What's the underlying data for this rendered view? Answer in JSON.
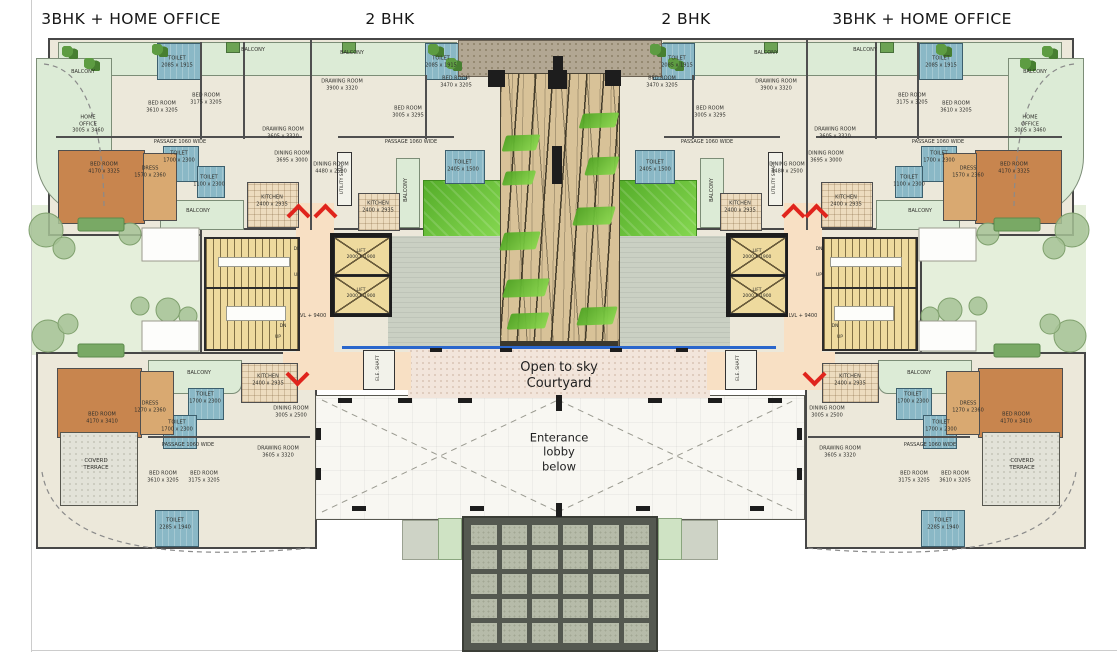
{
  "header": {
    "unit_types": [
      "3BHK + HOME OFFICE",
      "2 BHK",
      "2 BHK",
      "3BHK + HOME OFFICE"
    ]
  },
  "courtyard": {
    "label": "Open to sky\nCourtyard"
  },
  "lobby": {
    "label": "Enterance\nlobby\nbelow"
  },
  "colors": {
    "wall": "#474747",
    "floor": "#ece8da",
    "balcony": "#dcebd6",
    "lawn": "#5cb32e",
    "deck": "#d8c298",
    "toilet": "#8ab8c6",
    "master_bedroom": "#c8854e",
    "corridor": "#f8e0c4",
    "stair": "#eeda9e",
    "courtyard": "#f2e5db",
    "accent_arrow": "#e0241c",
    "water_line": "#2a66cc"
  },
  "chevrons": [
    {
      "x": 290,
      "y": 207,
      "dir": "up"
    },
    {
      "x": 317,
      "y": 207,
      "dir": "up"
    },
    {
      "x": 289,
      "y": 366,
      "dir": "down"
    },
    {
      "x": 785,
      "y": 207,
      "dir": "up"
    },
    {
      "x": 808,
      "y": 207,
      "dir": "up"
    },
    {
      "x": 806,
      "y": 366,
      "dir": "down"
    }
  ],
  "plan_labels": [
    {
      "text": "LVL + 9400",
      "x": 312,
      "y": 316,
      "size": 5
    },
    {
      "text": "LVL + 9400",
      "x": 803,
      "y": 316,
      "size": 5
    },
    {
      "text": "ELE. SHAFT",
      "x": 379,
      "y": 368,
      "size": 4.5,
      "rot": -90
    },
    {
      "text": "ELE. SHAFT",
      "x": 739,
      "y": 368,
      "size": 4.5,
      "rot": -90
    },
    {
      "text": "UTILITY SHAFT",
      "x": 343,
      "y": 178,
      "size": 4.5,
      "rot": -90
    },
    {
      "text": "UTILITY SHAFT",
      "x": 775,
      "y": 178,
      "size": 4.5,
      "rot": -90
    },
    {
      "text": "LIFT\n2000 X 1900",
      "x": 361,
      "y": 255,
      "size": 4.5
    },
    {
      "text": "LIFT\n2000 X 1900",
      "x": 361,
      "y": 294,
      "size": 4.5
    },
    {
      "text": "LIFT\n2000 X 1900",
      "x": 757,
      "y": 255,
      "size": 4.5
    },
    {
      "text": "LIFT\n2000 X 1900",
      "x": 757,
      "y": 294,
      "size": 4.5
    },
    {
      "text": "DN",
      "x": 297,
      "y": 250,
      "size": 4.5
    },
    {
      "text": "UP",
      "x": 297,
      "y": 276,
      "size": 4.5
    },
    {
      "text": "DN",
      "x": 283,
      "y": 327,
      "size": 4.5
    },
    {
      "text": "UP",
      "x": 278,
      "y": 338,
      "size": 4.5
    },
    {
      "text": "DN",
      "x": 819,
      "y": 250,
      "size": 4.5
    },
    {
      "text": "UP",
      "x": 819,
      "y": 276,
      "size": 4.5
    },
    {
      "text": "DN",
      "x": 835,
      "y": 327,
      "size": 4.5
    },
    {
      "text": "UP",
      "x": 840,
      "y": 338,
      "size": 4.5
    },
    {
      "text": "BALCONY",
      "x": 83,
      "y": 72
    },
    {
      "text": "TOILET\n2085 x 1915",
      "x": 177,
      "y": 62
    },
    {
      "text": "BED ROOM\n3610 x 3205",
      "x": 162,
      "y": 107
    },
    {
      "text": "BED ROOM\n3175 x 3205",
      "x": 206,
      "y": 99
    },
    {
      "text": "HOME\nOFFICE\n3005 x 3460",
      "x": 88,
      "y": 124
    },
    {
      "text": "DRAWING ROOM\n3605 x 3320",
      "x": 283,
      "y": 133
    },
    {
      "text": "PASSAGE 1060 WIDE",
      "x": 180,
      "y": 142
    },
    {
      "text": "BED ROOM\n4170 x 3325",
      "x": 104,
      "y": 168
    },
    {
      "text": "DRESS\n1570 x 2360",
      "x": 150,
      "y": 172
    },
    {
      "text": "TOILET\n1700 x 2300",
      "x": 179,
      "y": 157
    },
    {
      "text": "TOILET\n1100 x 2300",
      "x": 209,
      "y": 181
    },
    {
      "text": "DINING ROOM\n3695 x 3000",
      "x": 292,
      "y": 157
    },
    {
      "text": "BALCONY",
      "x": 198,
      "y": 211
    },
    {
      "text": "KITCHEN\n2400 x 2935",
      "x": 272,
      "y": 201
    },
    {
      "text": "BALCONY",
      "x": 253,
      "y": 50
    },
    {
      "text": "BALCONY",
      "x": 352,
      "y": 53
    },
    {
      "text": "DRAWING ROOM\n3900 x 3320",
      "x": 342,
      "y": 85
    },
    {
      "text": "BED ROOM\n3005 x 3295",
      "x": 408,
      "y": 112
    },
    {
      "text": "BED ROOM\n3470 x 3205",
      "x": 456,
      "y": 82
    },
    {
      "text": "TOILET\n2085 x 1915",
      "x": 441,
      "y": 62
    },
    {
      "text": "DINING ROOM\n4480 x 2500",
      "x": 331,
      "y": 168
    },
    {
      "text": "PASSAGE 1060 WIDE",
      "x": 411,
      "y": 142
    },
    {
      "text": "KITCHEN\n2400 x 2935",
      "x": 378,
      "y": 207
    },
    {
      "text": "TOILET\n2405 x 1500",
      "x": 463,
      "y": 166
    },
    {
      "text": "BALCONY",
      "x": 406,
      "y": 190,
      "rot": -90
    },
    {
      "text": "DRAWING ROOM\n3900 x 3320",
      "x": 776,
      "y": 85
    },
    {
      "text": "BED ROOM\n3005 x 3295",
      "x": 710,
      "y": 112
    },
    {
      "text": "BED ROOM\n3470 x 3205",
      "x": 662,
      "y": 82
    },
    {
      "text": "TOILET\n2085 x 1915",
      "x": 677,
      "y": 62
    },
    {
      "text": "DINING ROOM\n4480 x 2500",
      "x": 787,
      "y": 168
    },
    {
      "text": "PASSAGE 1060 WIDE",
      "x": 707,
      "y": 142
    },
    {
      "text": "KITCHEN\n2400 x 2935",
      "x": 740,
      "y": 207
    },
    {
      "text": "TOILET\n2405 x 1500",
      "x": 655,
      "y": 166
    },
    {
      "text": "BALCONY",
      "x": 712,
      "y": 190,
      "rot": -90
    },
    {
      "text": "BALCONY",
      "x": 1035,
      "y": 72
    },
    {
      "text": "TOILET\n2085 x 1915",
      "x": 941,
      "y": 62
    },
    {
      "text": "BED ROOM\n3610 x 3205",
      "x": 956,
      "y": 107
    },
    {
      "text": "BED ROOM\n3175 x 3205",
      "x": 912,
      "y": 99
    },
    {
      "text": "HOME\nOFFICE\n3005 x 3460",
      "x": 1030,
      "y": 124
    },
    {
      "text": "DRAWING ROOM\n3605 x 3320",
      "x": 835,
      "y": 133
    },
    {
      "text": "PASSAGE 1060 WIDE",
      "x": 938,
      "y": 142
    },
    {
      "text": "BED ROOM\n4170 x 3325",
      "x": 1014,
      "y": 168
    },
    {
      "text": "DRESS\n1570 x 2360",
      "x": 968,
      "y": 172
    },
    {
      "text": "TOILET\n1700 x 2300",
      "x": 939,
      "y": 157
    },
    {
      "text": "TOILET\n1100 x 2300",
      "x": 909,
      "y": 181
    },
    {
      "text": "DINING ROOM\n3695 x 3000",
      "x": 826,
      "y": 157
    },
    {
      "text": "BALCONY",
      "x": 920,
      "y": 211
    },
    {
      "text": "KITCHEN\n2400 x 2935",
      "x": 846,
      "y": 201
    },
    {
      "text": "BALCONY",
      "x": 865,
      "y": 50
    },
    {
      "text": "BALCONY",
      "x": 766,
      "y": 53
    },
    {
      "text": "BED ROOM\n4170 x 3410",
      "x": 102,
      "y": 418
    },
    {
      "text": "DRESS\n1270 x 2360",
      "x": 150,
      "y": 407
    },
    {
      "text": "TOILET\n1700 x 2300",
      "x": 205,
      "y": 398
    },
    {
      "text": "TOILET\n1700 x 2300",
      "x": 177,
      "y": 426
    },
    {
      "text": "BALCONY",
      "x": 199,
      "y": 373
    },
    {
      "text": "KITCHEN\n2400 x 2935",
      "x": 268,
      "y": 380
    },
    {
      "text": "DINING ROOM\n3005 x 2500",
      "x": 291,
      "y": 412
    },
    {
      "text": "DRAWING ROOM\n3605 x 3320",
      "x": 278,
      "y": 452
    },
    {
      "text": "PASSAGE 1060 WIDE",
      "x": 188,
      "y": 445
    },
    {
      "text": "COVERD\nTERRACE",
      "x": 96,
      "y": 465,
      "size": 5.5
    },
    {
      "text": "BED ROOM\n3610 x 3205",
      "x": 163,
      "y": 477
    },
    {
      "text": "BED ROOM\n3175 x 3205",
      "x": 204,
      "y": 477
    },
    {
      "text": "TOILET\n2285 x 1940",
      "x": 175,
      "y": 524
    },
    {
      "text": "BED ROOM\n4170 x 3410",
      "x": 1016,
      "y": 418
    },
    {
      "text": "DRESS\n1270 x 2360",
      "x": 968,
      "y": 407
    },
    {
      "text": "TOILET\n1700 x 2300",
      "x": 913,
      "y": 398
    },
    {
      "text": "TOILET\n1700 x 2300",
      "x": 941,
      "y": 426
    },
    {
      "text": "BALCONY",
      "x": 919,
      "y": 373
    },
    {
      "text": "KITCHEN\n2400 x 2935",
      "x": 850,
      "y": 380
    },
    {
      "text": "DINING ROOM\n3005 x 2500",
      "x": 827,
      "y": 412
    },
    {
      "text": "DRAWING ROOM\n3605 x 3320",
      "x": 840,
      "y": 452
    },
    {
      "text": "PASSAGE 1060 WIDE",
      "x": 930,
      "y": 445
    },
    {
      "text": "COVERD\nTERRACE",
      "x": 1022,
      "y": 465,
      "size": 5.5
    },
    {
      "text": "BED ROOM\n3610 x 3205",
      "x": 955,
      "y": 477
    },
    {
      "text": "BED ROOM\n3175 x 3205",
      "x": 914,
      "y": 477
    },
    {
      "text": "TOILET\n2285 x 1940",
      "x": 943,
      "y": 524
    }
  ]
}
